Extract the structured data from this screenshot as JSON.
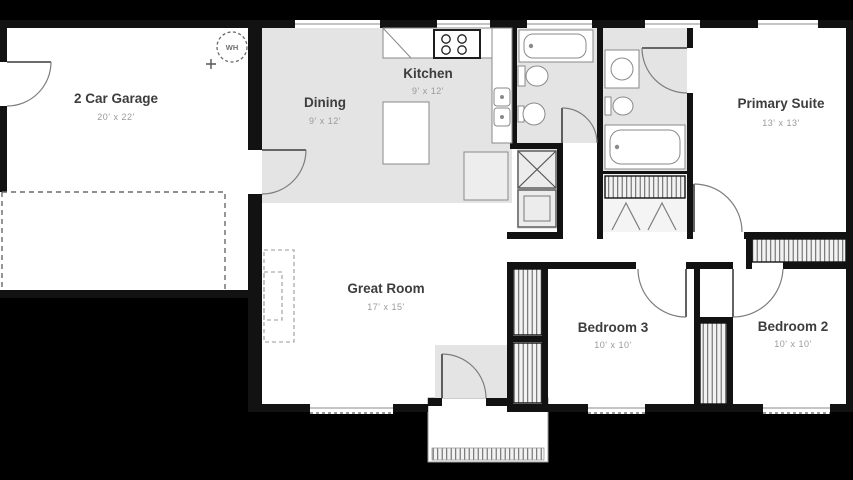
{
  "page": {
    "type": "residential-floor-plan",
    "colors": {
      "background": "#000000",
      "walls": "#121212",
      "floor_shaded": "#e4e4e4",
      "floor_white": "#ffffff",
      "room_label": "#3d3d3d",
      "room_dims": "#9a9a9a"
    },
    "rooms": {
      "garage": {
        "name": "2 Car Garage",
        "dims": "20' x 22'"
      },
      "dining": {
        "name": "Dining",
        "dims": "9' x 12'"
      },
      "kitchen": {
        "name": "Kitchen",
        "dims": "9' x 12'"
      },
      "primary_suite": {
        "name": "Primary Suite",
        "dims": "13' x 13'"
      },
      "great_room": {
        "name": "Great Room",
        "dims": "17' x 15'"
      },
      "bedroom_3": {
        "name": "Bedroom 3",
        "dims": "10' x 10'"
      },
      "bedroom_2": {
        "name": "Bedroom 2",
        "dims": "10' x 10'"
      }
    },
    "fixtures": {
      "water_heater": "WH",
      "icon_names": [
        "water-heater-icon",
        "range-icon",
        "kitchen-sink-icon",
        "kitchen-island",
        "refrigerator-icon",
        "washer-icon",
        "dryer-icon",
        "bathtub-icon",
        "toilet-icon",
        "lavatory-sink-icon",
        "door-swing-icon",
        "window-icon",
        "closet-rod-hatch",
        "garage-door-dashed",
        "porch-decking",
        "fireplace-dashed"
      ]
    }
  }
}
